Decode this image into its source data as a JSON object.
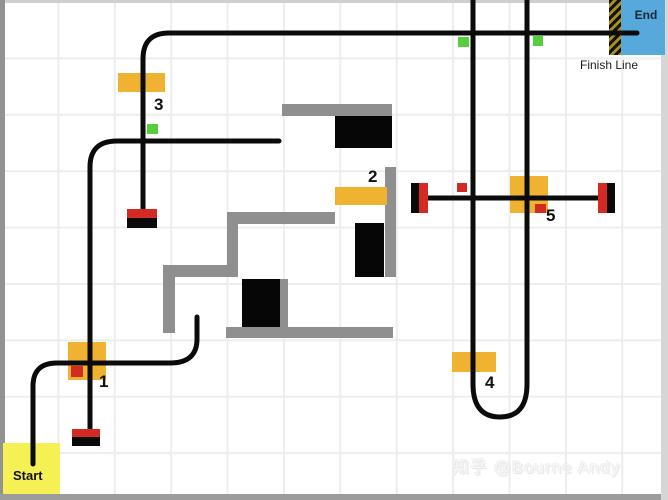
{
  "canvas": {
    "width": 668,
    "height": 500,
    "grid_spacing": 56
  },
  "labels": {
    "start": "Start",
    "end": "End",
    "finish_line": "Finish Line"
  },
  "watermark": {
    "text": "知乎 @Bourne Andy"
  },
  "colors": {
    "path": "#0b0b0b",
    "wall": "#8f8f8f",
    "obstacle": "#060606",
    "checkpoint": "#efb331",
    "marker_red": "#d32b23",
    "marker_black": "#0a0a0a",
    "green_square": "#56cf3c",
    "red_square": "#d32b23",
    "start_bg": "#f5f155",
    "end_bg": "#57a9dc",
    "hatch_gold": "#a8901f",
    "grid": "#ededed",
    "label_text": "#111111"
  },
  "map": {
    "paths": [
      {
        "name": "path-start-curve",
        "d": "M 33 464 L 33 386 Q 33 363 57 363 L 170 363 Q 197 363 197 339 L 197 317"
      },
      {
        "name": "path-checkpoint1-vertical",
        "d": "M 90 431 L 90 167 Q 90 141 117 141 L 279 141"
      },
      {
        "name": "path-checkpoint3-to-finish",
        "d": "M 143 211 L 143 59 Q 143 33 169 33 L 637 33"
      },
      {
        "name": "path-u-turn",
        "d": "M 473 0 L 473 384 Q 473 417 500 417 Q 527 417 527 384 L 527 0"
      },
      {
        "name": "path-checkpoint5-horizontal",
        "d": "M 423 198 L 603 198"
      }
    ],
    "walls": [
      [
        282,
        104,
        110,
        12
      ],
      [
        385,
        167,
        11,
        110
      ],
      [
        227,
        212,
        108,
        12
      ],
      [
        227,
        224,
        11,
        53
      ],
      [
        163,
        265,
        75,
        12
      ],
      [
        163,
        277,
        12,
        56
      ],
      [
        280,
        279,
        8,
        48
      ],
      [
        226,
        327,
        167,
        11
      ]
    ],
    "obstacles": [
      [
        335,
        116,
        57,
        32
      ],
      [
        355,
        223,
        29,
        54
      ],
      [
        242,
        279,
        38,
        48
      ]
    ],
    "checkpoint_boxes": [
      {
        "label": "1",
        "x": 68,
        "y": 342,
        "w": 38,
        "h": 38,
        "lx": 99,
        "ly": 387
      },
      {
        "label": "2",
        "x": 335,
        "y": 187,
        "w": 52,
        "h": 18,
        "lx": 368,
        "ly": 182
      },
      {
        "label": "3",
        "x": 118,
        "y": 73,
        "w": 47,
        "h": 19,
        "lx": 154,
        "ly": 110
      },
      {
        "label": "4",
        "x": 452,
        "y": 352,
        "w": 44,
        "h": 20,
        "lx": 485,
        "ly": 388
      },
      {
        "label": "5",
        "x": 510,
        "y": 176,
        "w": 38,
        "h": 37,
        "lx": 546,
        "ly": 221
      }
    ],
    "markers": [
      {
        "name": "marker-start-red",
        "x": 72,
        "y": 429,
        "w": 28,
        "h": 8,
        "color": "red"
      },
      {
        "name": "marker-start-black",
        "x": 72,
        "y": 437,
        "w": 28,
        "h": 9,
        "color": "black"
      },
      {
        "name": "marker-cp3-red",
        "x": 127,
        "y": 209,
        "w": 30,
        "h": 9,
        "color": "red"
      },
      {
        "name": "marker-cp3-black",
        "x": 127,
        "y": 218,
        "w": 30,
        "h": 10,
        "color": "black"
      },
      {
        "name": "marker-cp5-left-black",
        "x": 411,
        "y": 183,
        "w": 8,
        "h": 30,
        "color": "black"
      },
      {
        "name": "marker-cp5-left-red",
        "x": 419,
        "y": 183,
        "w": 9,
        "h": 30,
        "color": "red"
      },
      {
        "name": "marker-cp5-right-red",
        "x": 598,
        "y": 183,
        "w": 9,
        "h": 30,
        "color": "red"
      },
      {
        "name": "marker-cp5-right-black",
        "x": 607,
        "y": 183,
        "w": 8,
        "h": 30,
        "color": "black"
      }
    ],
    "green_squares": [
      [
        147,
        124,
        11,
        10
      ],
      [
        458,
        37,
        11,
        10
      ],
      [
        533,
        36,
        10,
        10
      ]
    ],
    "red_squares": [
      [
        71,
        366,
        12,
        11
      ],
      [
        457,
        183,
        10,
        9
      ],
      [
        535,
        204,
        11,
        9
      ]
    ]
  }
}
